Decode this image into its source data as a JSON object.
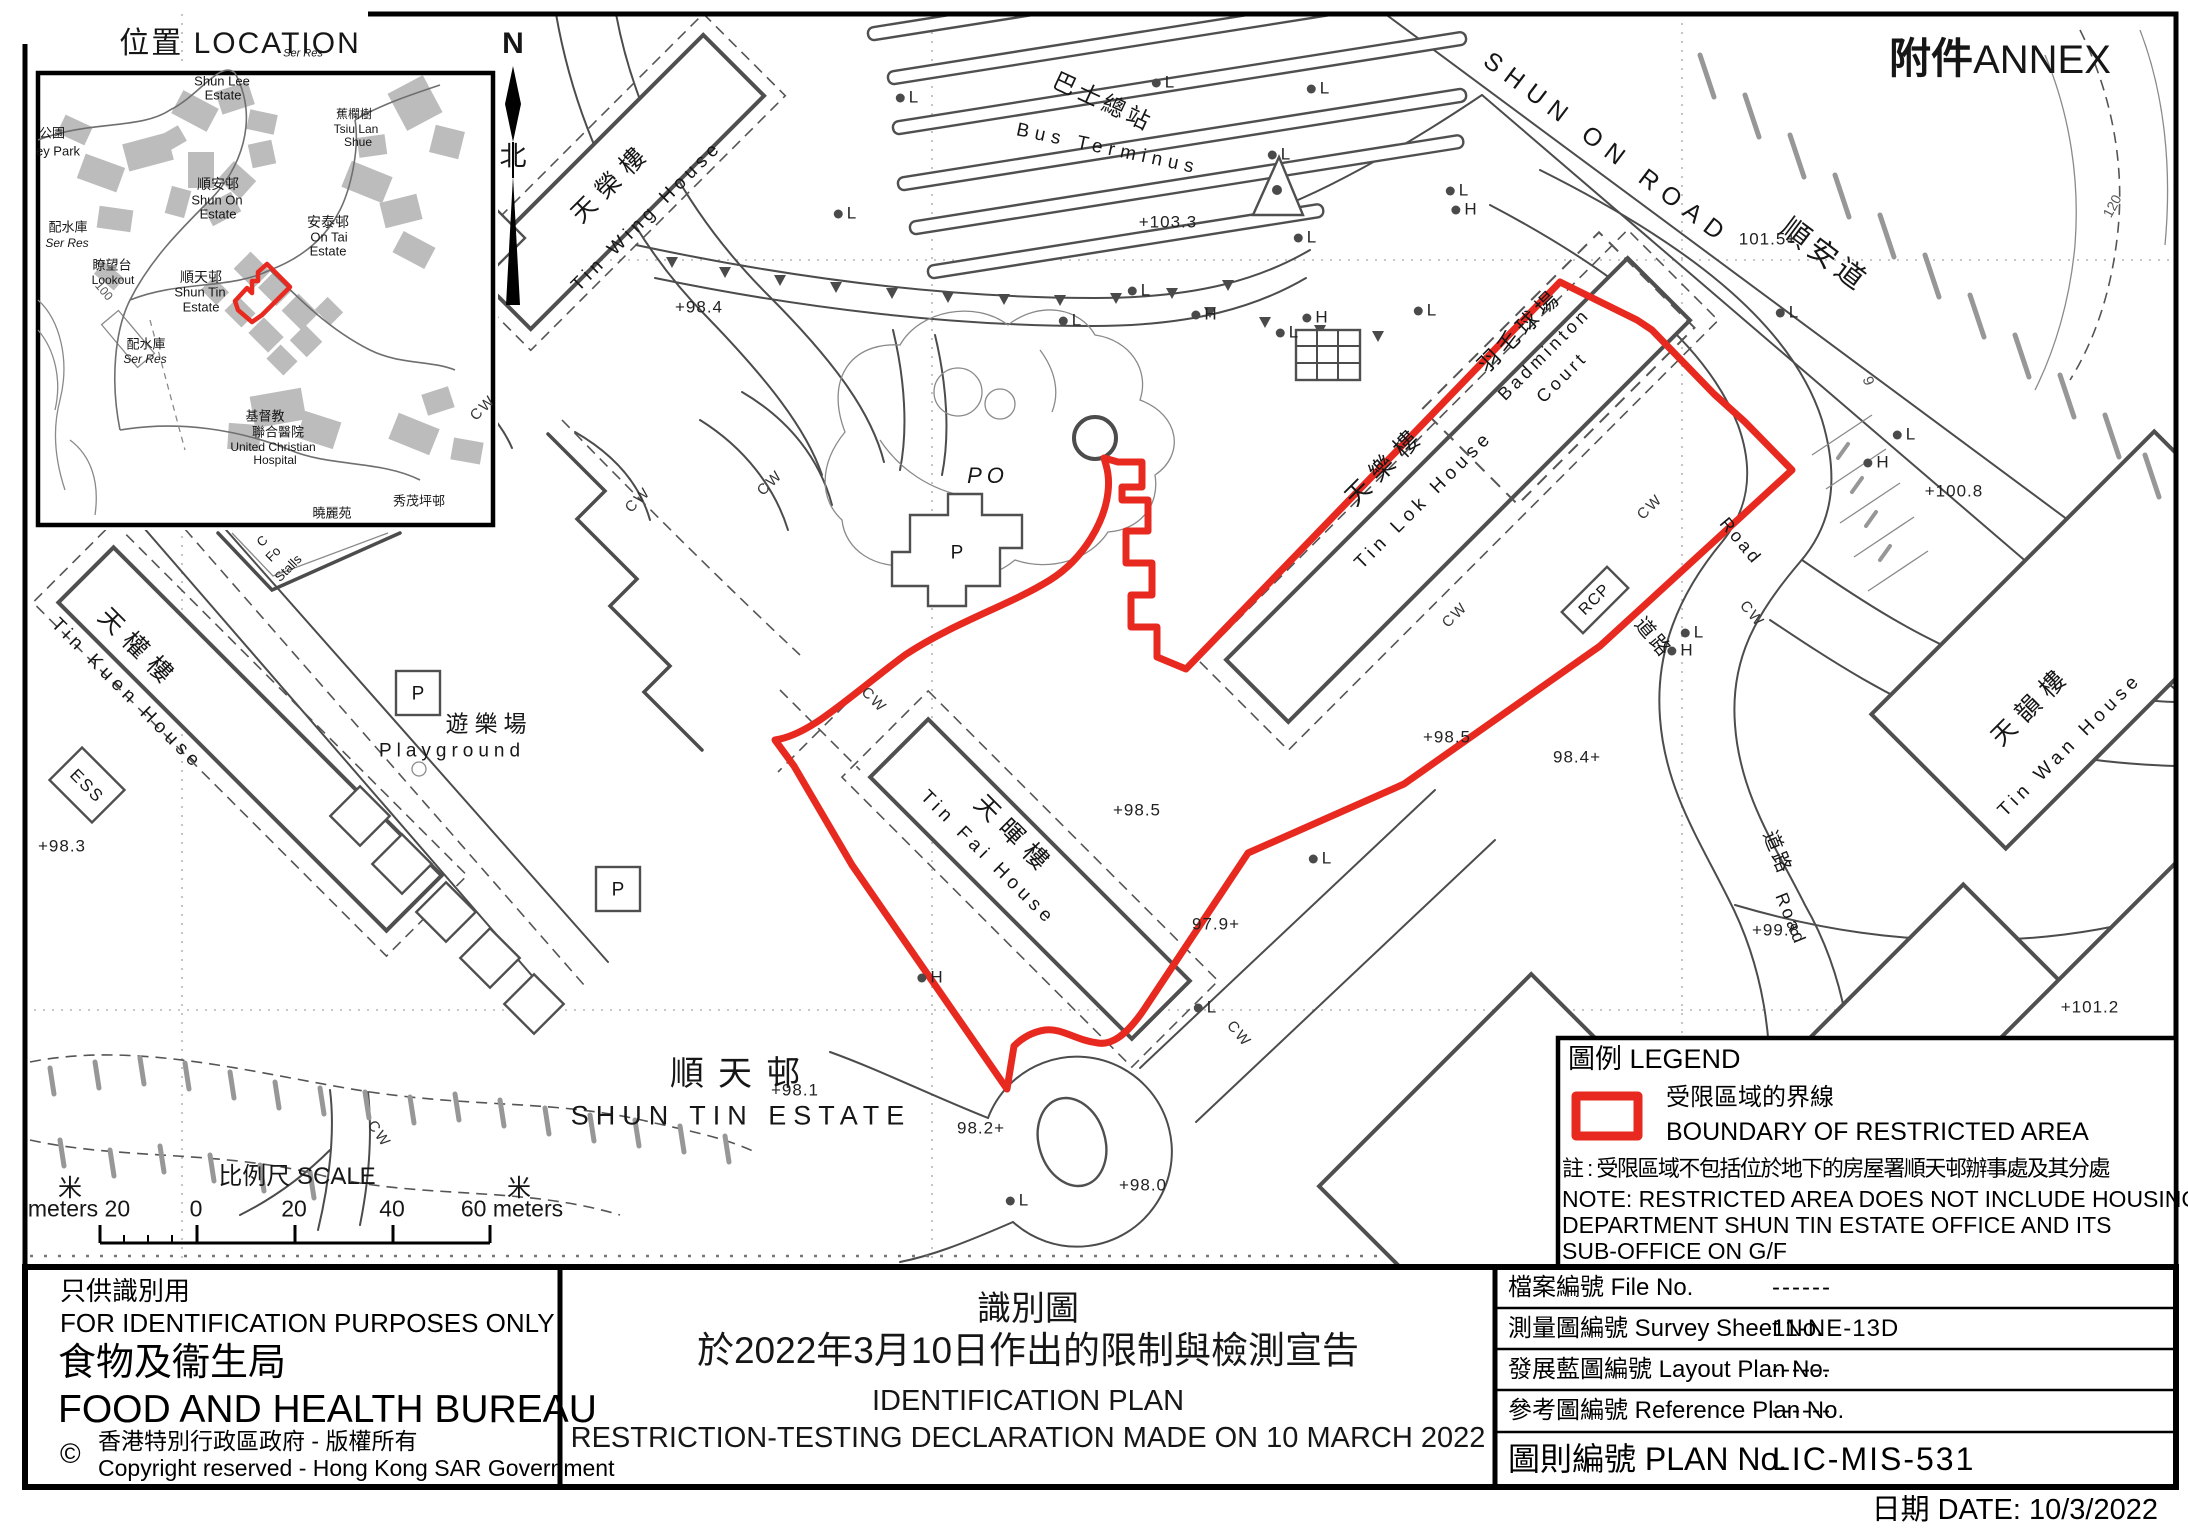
{
  "colors": {
    "boundary_red": "#e8291f"
  },
  "annex": {
    "cn": "附件",
    "en": "ANNEX"
  },
  "north": {
    "n": "N",
    "cn": "北"
  },
  "inset": {
    "title": "位置  LOCATION",
    "shun_lee_1": "Shun Lee",
    "shun_lee_2": "Estate",
    "park_cn": "公園",
    "park_en": "ey Park",
    "ser_res_top": "Ser Res",
    "tsiu_cn": "蕉欄樹",
    "tsiu_en_1": "Tsiu Lan",
    "tsiu_en_2": "Shue",
    "shun_on_cn": "順安邨",
    "shun_on_en_1": "Shun On",
    "shun_on_en_2": "Estate",
    "on_tai_cn": "安泰邨",
    "on_tai_en_1": "On Tai",
    "on_tai_en_2": "Estate",
    "ser_res_1_cn": "配水庫",
    "ser_res_1_en": "Ser Res",
    "lookout_cn": "瞭望台",
    "lookout_en": "Lookout",
    "shun_tin_cn": "順天邨",
    "shun_tin_en_1": "Shun Tin",
    "shun_tin_en_2": "Estate",
    "ser_res_2_cn": "配水庫",
    "ser_res_2_en": "Ser Res",
    "hospital_cn_1": "基督教",
    "hospital_cn_2": "聯合醫院",
    "hospital_en_1": "United Christian",
    "hospital_en_2": "Hospital",
    "hiu_lai_cn": "曉麗苑",
    "hiu_lai_en": "Hiu Lai",
    "sau_mau_ping": "秀茂坪邨",
    "contour_100": "100"
  },
  "map": {
    "tin_wing_cn": "天榮樓",
    "tin_wing_en": "Tin Wing House",
    "tin_lok_cn": "天樂樓",
    "tin_lok_en": "Tin Lok House",
    "tin_wan_cn": "天韻樓",
    "tin_wan_en": "Tin Wan House",
    "tin_kuen_cn": "天權樓",
    "tin_kuen_en": "Tin Kuen House",
    "tin_fai_cn": "天暉樓",
    "tin_fai_en": "Tin Fai House",
    "bus_cn": "巴士總站",
    "bus_en": "Bus Terminus",
    "shun_on_road": "SHUN ON ROAD",
    "shun_on_road_cn": "順安道",
    "badminton_cn": "羽毛球場",
    "badminton_en_1": "Badminton",
    "badminton_en_2": "Court",
    "playground_cn": "遊樂場",
    "playground_en": "Playground",
    "po": "PO",
    "p": "P",
    "ess": "ESS",
    "rcp": "RCP",
    "cw": "CW",
    "road_cn": "道路",
    "road_en": "Road",
    "stalls_1": "C",
    "stalls_2": "Fo",
    "stalls_3": "Stalls",
    "contour_9": "9",
    "contour_120": "120",
    "estate_cn": "順天邨",
    "estate_en": "SHUN TIN ESTATE",
    "l": "L",
    "h": "H",
    "spots": [
      "+98.4",
      "+103.3",
      "101.5+",
      "+100.8",
      "+98.5",
      "98.4+",
      "+98.5",
      "97.9+",
      "+99.8",
      "+101.2",
      "+98.3",
      "98.2+",
      "+98.0",
      "+98.1"
    ]
  },
  "scale": {
    "title": "比例尺  SCALE",
    "m_left": "米",
    "m_right": "米",
    "left_20": "meters 20",
    "v0": "0",
    "v20": "20",
    "v40": "40",
    "v60": "60 meters"
  },
  "legend": {
    "title": "圖例 LEGEND",
    "boundary_cn": "受限區域的界線",
    "boundary_en": "BOUNDARY OF RESTRICTED AREA",
    "note_cn": "註 : 受限區域不包括位於地下的房屋署順天邨辦事處及其分處",
    "note_en_1": "NOTE: RESTRICTED AREA DOES NOT INCLUDE HOUSING",
    "note_en_2": "DEPARTMENT SHUN TIN ESTATE OFFICE AND ITS",
    "note_en_3": "SUB-OFFICE ON G/F"
  },
  "footer": {
    "id_cn": "只供識別用",
    "id_en": "FOR IDENTIFICATION PURPOSES ONLY",
    "bureau_cn": "食物及衞生局",
    "bureau_en": "FOOD AND HEALTH BUREAU",
    "copyright_symbol": "©",
    "copyright_cn": "香港特別行政區政府 - 版權所有",
    "copyright_en": "Copyright reserved - Hong Kong SAR Government",
    "title_cn_1": "識別圖",
    "title_cn_2": "於2022年3月10日作出的限制與檢測宣告",
    "title_en_1": "IDENTIFICATION PLAN",
    "title_en_2": "RESTRICTION-TESTING DECLARATION MADE ON 10 MARCH 2022",
    "table": {
      "rows": [
        {
          "label": "檔案編號  File  No.",
          "value": "------"
        },
        {
          "label": "測量圖編號  Survey  Sheet  No.",
          "value": "11-NE-13D"
        },
        {
          "label": "發展藍圖編號  Layout  Plan  No.",
          "value": "------"
        },
        {
          "label": "參考圖編號  Reference  Plan  No.",
          "value": "------"
        },
        {
          "label": "圖則編號   PLAN   No.",
          "value": "LIC-MIS-531"
        }
      ]
    },
    "date": "日期 DATE:  10/3/2022"
  }
}
